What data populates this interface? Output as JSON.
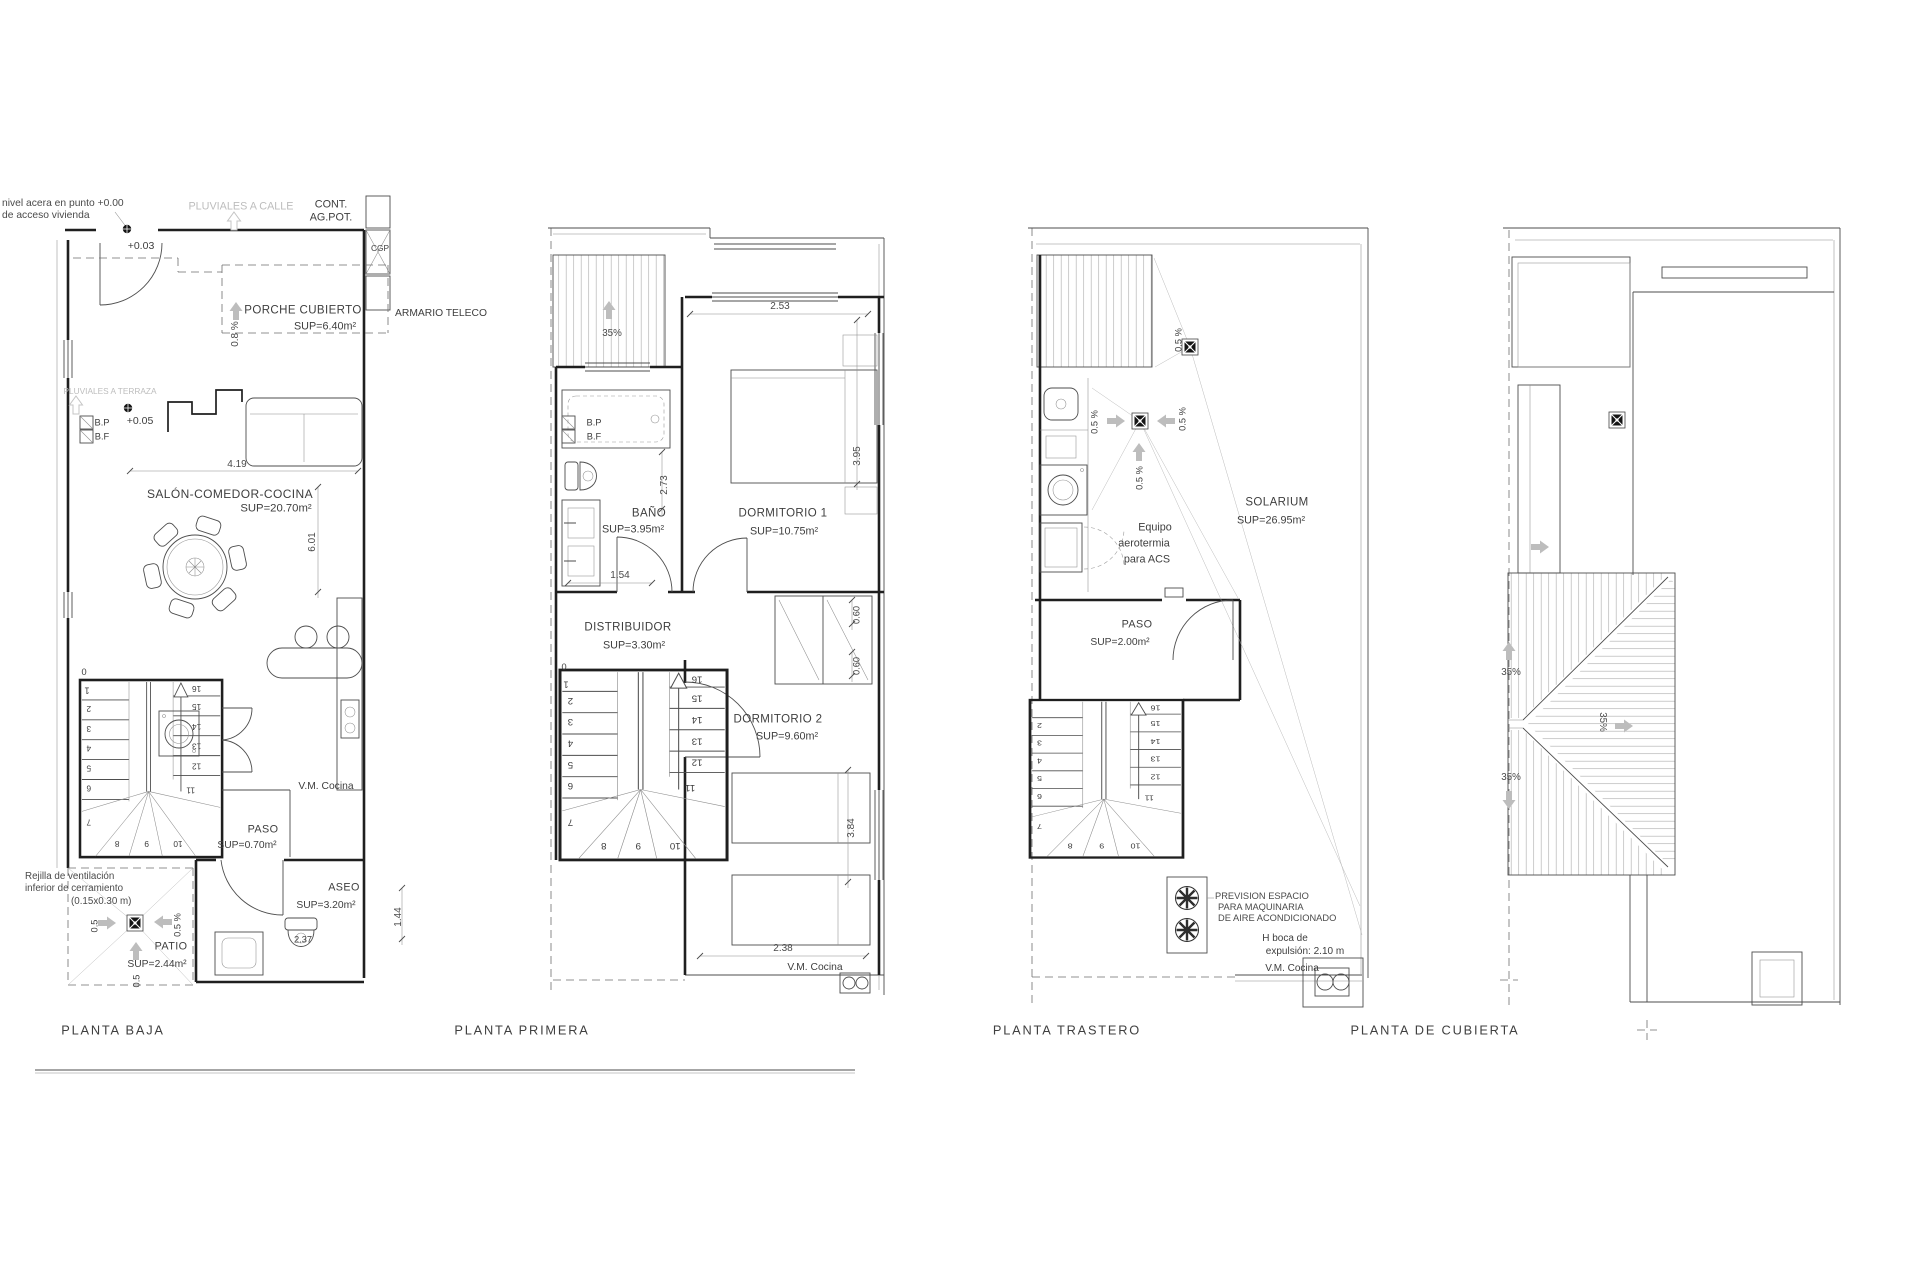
{
  "common": {
    "pct05": "0.5 %",
    "p05": "0.5",
    "pct35": "35%",
    "pct08": "0.8 %",
    "vm_cocina": "V.M. Cocina",
    "bp": "B.P",
    "bf": "B.F",
    "paso": "PASO"
  },
  "stair": {
    "n0": "0",
    "n1": "1",
    "n2": "2",
    "n3": "3",
    "n4": "4",
    "n5": "5",
    "n6": "6",
    "n7": "7",
    "n8": "8",
    "n9": "9",
    "n10": "10",
    "n11": "11",
    "n12": "12",
    "n13": "13",
    "n14": "14",
    "n15": "15",
    "n16": "16"
  },
  "pb": {
    "caption": "PLANTA BAJA",
    "nivel1": "nivel acera en punto +0.00",
    "nivel2": "de acceso vivienda",
    "pluviales_calle": "PLUVIALES A CALLE",
    "cont": "CONT.",
    "agpot": "AG.POT.",
    "cgp": "CGP",
    "lvl003": "+0.03",
    "porche": "PORCHE CUBIERTO",
    "porche_sup": "SUP=6.40m²",
    "armario": "ARMARIO TELECO",
    "pluviales_terraza": "PLUVIALES A TERRAZA",
    "lvl005": "+0.05",
    "dim419": "4.19",
    "salon": "SALÓN-COMEDOR-COCINA",
    "salon_sup": "SUP=20.70m²",
    "dim601": "6.01",
    "paso_sup": "SUP=0.70m²",
    "rejilla1": "Rejilla de ventilación",
    "rejilla2": "inferior de cerramiento",
    "rejilla3": "(0.15x0.30 m)",
    "patio": "PATIO",
    "patio_sup": "SUP=2.44m²",
    "aseo": "ASEO",
    "aseo_sup": "SUP=3.20m²",
    "dim237": "2.37",
    "dim144": "1.44"
  },
  "p1": {
    "caption": "PLANTA PRIMERA",
    "dim253": "2.53",
    "bano": "BAÑO",
    "bano_sup": "SUP=3.95m²",
    "dim273": "2.73",
    "dorm1": "DORMITORIO 1",
    "dorm1_sup": "SUP=10.75m²",
    "dim395": "3.95",
    "dim154": "1.54",
    "distribuidor": "DISTRIBUIDOR",
    "distribuidor_sup": "SUP=3.30m²",
    "dim060": "0.60",
    "dorm2": "DORMITORIO 2",
    "dorm2_sup": "SUP=9.60m²",
    "dim384": "3.84",
    "dim238": "2.38"
  },
  "pt": {
    "caption": "PLANTA TRASTERO",
    "equipo1": "Equipo",
    "equipo2": "aerotermia",
    "equipo3": "para ACS",
    "solarium": "SOLARIUM",
    "solarium_sup": "SUP=26.95m²",
    "paso_sup": "SUP=2.00m²",
    "prevision1": "PREVISION ESPACIO",
    "prevision2": "PARA MAQUINARIA",
    "prevision3": "DE AIRE ACONDICIONADO",
    "boca1": "H boca de",
    "boca2": "expulsión: 2.10 m"
  },
  "pc": {
    "caption": "PLANTA DE CUBIERTA"
  }
}
